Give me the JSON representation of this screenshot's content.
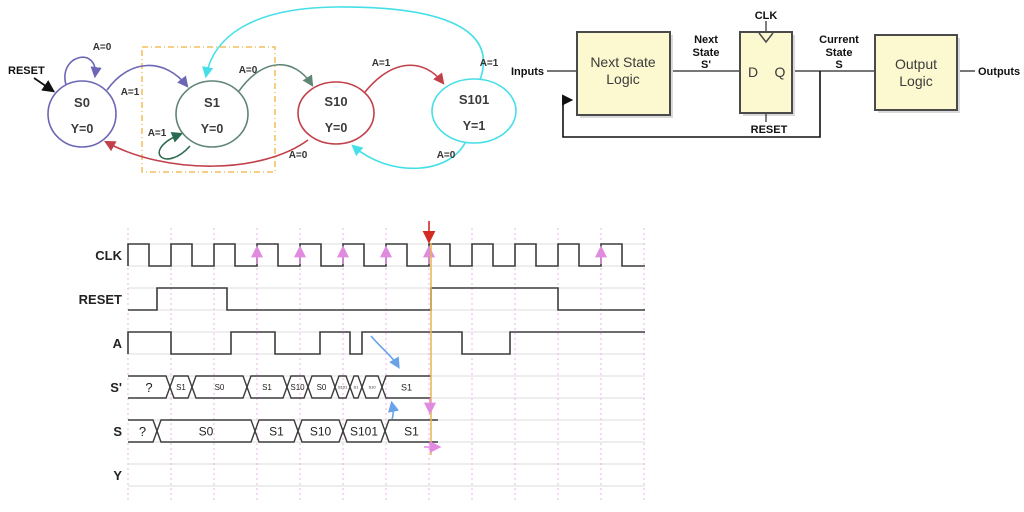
{
  "state_diagram": {
    "reset_label": "RESET",
    "states": [
      {
        "name": "S0",
        "output": "Y=0",
        "color": "#6b66b5"
      },
      {
        "name": "S1",
        "output": "Y=0",
        "color": "#5f8575"
      },
      {
        "name": "S10",
        "output": "Y=0",
        "color": "#c2404a"
      },
      {
        "name": "S101",
        "output": "Y=1",
        "color": "#45dfe8"
      }
    ],
    "transitions": [
      {
        "label": "A=0",
        "color": "#6b66b5"
      },
      {
        "label": "A=1",
        "color": "#6b66b5"
      },
      {
        "label": "A=1",
        "color": "#2a6b4f"
      },
      {
        "label": "A=0",
        "color": "#5f8575"
      },
      {
        "label": "A=1",
        "color": "#c2404a"
      },
      {
        "label": "A=1",
        "color": "#45dfe8"
      },
      {
        "label": "A=0",
        "color": "#c2404a"
      },
      {
        "label": "A=0",
        "color": "#45dfe8"
      }
    ],
    "dashed_box_color": "#f0b23e"
  },
  "block_diagram": {
    "inputs_label": "Inputs",
    "outputs_label": "Outputs",
    "next_state_logic": {
      "line1": "Next State",
      "line2": "Logic"
    },
    "output_logic": {
      "line1": "Output",
      "line2": "Logic"
    },
    "dff": {
      "d_label": "D",
      "q_label": "Q",
      "clk_label": "CLK",
      "reset_label": "RESET"
    },
    "next_state_signal": {
      "line1": "Next",
      "line2": "State",
      "line3": "S'"
    },
    "current_state_signal": {
      "line1": "Current",
      "line2": "State",
      "line3": "S"
    },
    "box_fill": "#fcf8cf",
    "box_border": "#4a4a4a"
  },
  "timing_diagram": {
    "colors": {
      "wave": "#3c3c3c",
      "guide": "#dcdcdc",
      "grid": "#e8a6e8",
      "pink_arrow": "#e08ae0",
      "red_arrow": "#d22b20",
      "orange_line": "#e8b44a",
      "blue_arrow": "#68a2e8"
    },
    "x_start": 128,
    "x_end": 645,
    "gridlines": [
      128,
      171,
      214,
      257,
      300,
      343,
      386,
      429,
      472,
      515,
      558,
      601,
      644
    ],
    "grid_y_top": 228,
    "grid_y_bottom": 500,
    "pink_arrow_edges": [
      257,
      300,
      343,
      386,
      429,
      601
    ],
    "red_marker_x": 429,
    "orange_line": {
      "x": 431,
      "y_top": 243,
      "y_bottom": 455
    },
    "rows": [
      {
        "label": "CLK",
        "type": "clock",
        "y_high": 244,
        "y_low": 266,
        "duty_px": 21,
        "num_rises": 12
      },
      {
        "label": "RESET",
        "type": "wave",
        "y_high": 288,
        "y_low": 310,
        "start_level": 0,
        "toggles": [
          157,
          227,
          431,
          558
        ]
      },
      {
        "label": "A",
        "type": "wave",
        "y_high": 332,
        "y_low": 354,
        "start_level": 0,
        "toggles": [
          128,
          171,
          231,
          275,
          320,
          350,
          362,
          462,
          510
        ]
      },
      {
        "label": "S'",
        "type": "bus",
        "y_high": 376,
        "y_low": 398,
        "bus_end": 431,
        "cells": [
          {
            "text": "?",
            "x1": 128,
            "x2": 170,
            "font": 13
          },
          {
            "text": "S1",
            "x1": 170,
            "x2": 192,
            "font": 8
          },
          {
            "text": "S0",
            "x1": 192,
            "x2": 247,
            "font": 8
          },
          {
            "text": "S1",
            "x1": 247,
            "x2": 287,
            "font": 8
          },
          {
            "text": "S10",
            "x1": 287,
            "x2": 308,
            "font": 8
          },
          {
            "text": "S0",
            "x1": 308,
            "x2": 335,
            "font": 8
          },
          {
            "text": "S101",
            "x1": 335,
            "x2": 350,
            "font": 4
          },
          {
            "text": "S1",
            "x1": 350,
            "x2": 362,
            "font": 4
          },
          {
            "text": "S10",
            "x1": 362,
            "x2": 382,
            "font": 4
          },
          {
            "text": "S1",
            "x1": 382,
            "x2": 431,
            "font": 9
          }
        ]
      },
      {
        "label": "S",
        "type": "bus",
        "y_high": 420,
        "y_low": 442,
        "bus_end": 438,
        "cells": [
          {
            "text": "?",
            "x1": 128,
            "x2": 157,
            "font": 13
          },
          {
            "text": "S0",
            "x1": 157,
            "x2": 255,
            "font": 12
          },
          {
            "text": "S1",
            "x1": 255,
            "x2": 298,
            "font": 12
          },
          {
            "text": "S10",
            "x1": 298,
            "x2": 343,
            "font": 12
          },
          {
            "text": "S101",
            "x1": 343,
            "x2": 385,
            "font": 12
          },
          {
            "text": "S1",
            "x1": 385,
            "x2": 438,
            "font": 12
          }
        ]
      },
      {
        "label": "Y",
        "type": "empty",
        "y_high": 464,
        "y_low": 486
      }
    ]
  }
}
